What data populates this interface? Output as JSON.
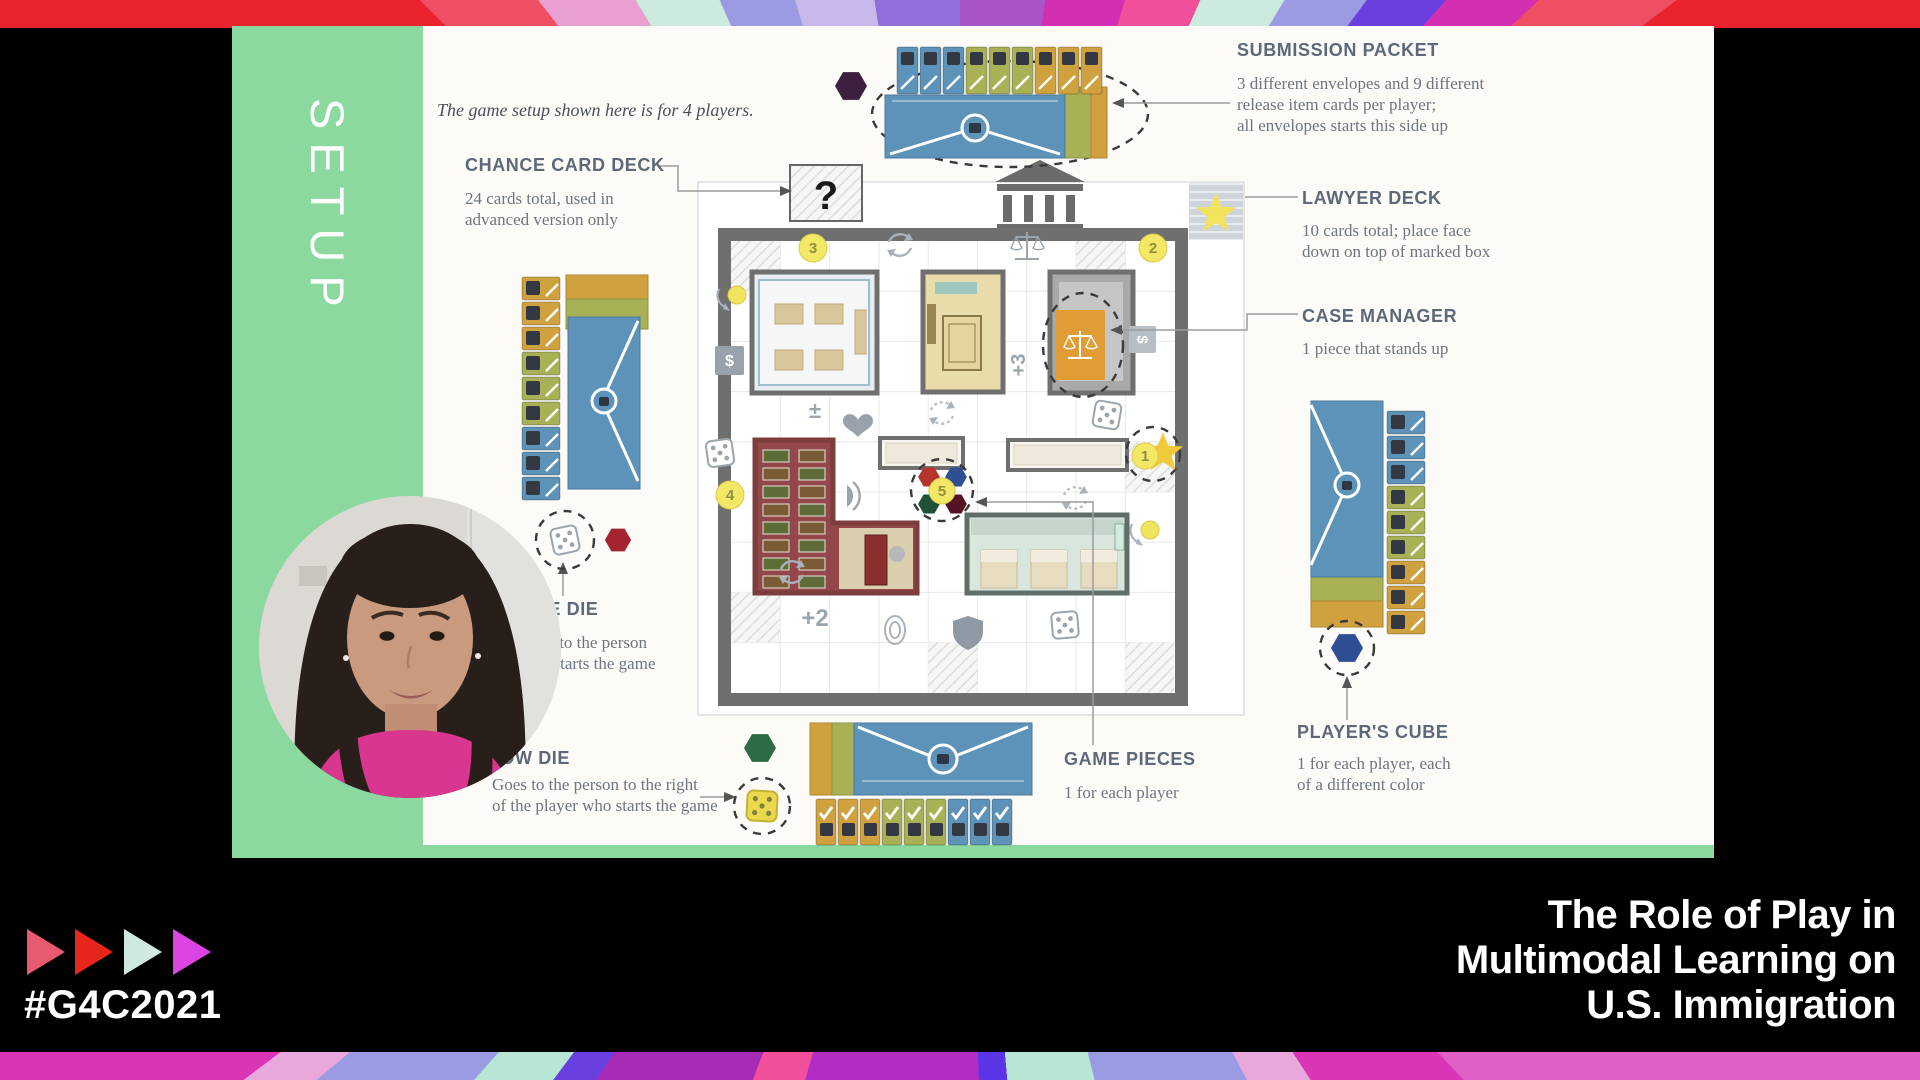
{
  "event": {
    "hashtag": "#G4C2021",
    "title_lines": [
      "The Role of Play in",
      "Multimodal Learning on",
      "U.S. Immigration"
    ],
    "triangle_colors": [
      "#e75b70",
      "#e6261b",
      "#cfe9e0",
      "#d944e3"
    ]
  },
  "slide": {
    "sidebar_label": "SETUP",
    "intro": "The game setup shown here is for 4 players.",
    "annotations": {
      "submission_packet": {
        "title": "SUBMISSION PACKET",
        "lines": [
          "3 different envelopes and 9 different",
          "release item cards per player;",
          "all envelopes starts this side up"
        ]
      },
      "chance_card_deck": {
        "title": "CHANCE CARD DECK",
        "lines": [
          "24 cards total, used in",
          "advanced version only"
        ]
      },
      "lawyer_deck": {
        "title": "LAWYER DECK",
        "lines": [
          "10 cards total; place face",
          "down on top of marked box"
        ]
      },
      "case_manager": {
        "title": "CASE MANAGER",
        "lines": [
          "1 piece that stands up"
        ]
      },
      "game_pieces": {
        "title": "GAME PIECES",
        "lines": [
          "1 for each player"
        ]
      },
      "players_cube": {
        "title": "PLAYER'S CUBE",
        "lines": [
          "1 for each player, each",
          "of a different color"
        ]
      },
      "white_die": {
        "title": "WHITE DIE",
        "lines": [
          "Goes to the person",
          "who starts the game"
        ]
      },
      "yellow_die": {
        "title": "YELLOW DIE",
        "lines": [
          "Goes to the person to the right",
          "of the player who starts the game"
        ]
      }
    },
    "board": {
      "chance_symbol": "?",
      "coin_top_left": "3",
      "coin_top_right": "2",
      "coin_left": "4",
      "coin_right": "1",
      "coin_center": "5",
      "plus_two": "+2",
      "plus_three": "+3",
      "plus_minus": "±",
      "dollar_left": "$",
      "dollar_right": "$"
    }
  },
  "colors": {
    "sidebar_green": "#8cd9a0",
    "slide_bg": "#fcfbf7",
    "annotation_title": "#5d6878",
    "annotation_body": "#6e7580",
    "envelope_blue": "#5d93b8",
    "envelope_olive": "#a9b157",
    "envelope_gold": "#d0a23f",
    "cube_red": "#b5352c",
    "cube_blue": "#2d4f93",
    "cube_green": "#1f5038",
    "cube_maroon": "#551426",
    "hex_purple": "#3d2040",
    "hex_dark_green": "#2e6b45",
    "hex_navy": "#2e4f93",
    "hex_dark_red": "#a32430",
    "title_white": "#ffffff"
  },
  "stripes": {
    "top": {
      "from": 296,
      "center": "960px 540px",
      "stops": [
        [
          "#e8232e",
          19
        ],
        [
          "#ee4f63",
          26
        ],
        [
          "#e9a0d0",
          33
        ],
        [
          "#cdeade",
          40
        ],
        [
          "#9b9be4",
          47
        ],
        [
          "#c9b8ea",
          55
        ],
        [
          "#8f6fd8",
          64
        ],
        [
          "#a855c8",
          73
        ],
        [
          "#d42fb2",
          81
        ],
        [
          "#f0509a",
          88
        ],
        [
          "#cdeade",
          95
        ],
        [
          "#9b9be4",
          101
        ],
        [
          "#6a3fe0",
          106
        ],
        [
          "#d42fb2",
          111
        ],
        [
          "#ee4f63",
          117
        ],
        [
          "#e8232e",
          126
        ]
      ]
    },
    "bottom": {
      "from": 116,
      "center": "960px -512px",
      "stops": [
        [
          "#e060c8",
          21
        ],
        [
          "#d935b5",
          31
        ],
        [
          "#e9a8dc",
          36
        ],
        [
          "#9b9be4",
          50
        ],
        [
          "#b8e6d5",
          59
        ],
        [
          "#5a35e6",
          62
        ],
        [
          "#b32cc4",
          80
        ],
        [
          "#f0509a",
          85
        ],
        [
          "#a62cb8",
          98
        ],
        [
          "#6a3fe0",
          101
        ],
        [
          "#b8e6d5",
          106
        ],
        [
          "#9b9be4",
          114
        ],
        [
          "#e9a8dc",
          117
        ],
        [
          "#d935b5",
          127
        ]
      ]
    }
  }
}
